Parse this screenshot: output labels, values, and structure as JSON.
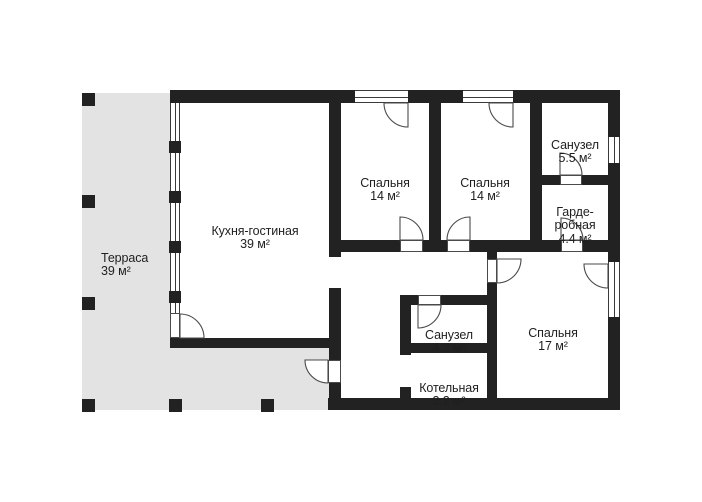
{
  "plan_title": "floor-plan",
  "rooms": [
    {
      "id": "terrace",
      "name": "Терраса",
      "area": "39 м²"
    },
    {
      "id": "kitchen-living",
      "name": "Кухня-гостиная",
      "area": "39 м²"
    },
    {
      "id": "bedroom-1",
      "name": "Спальня",
      "area": "14 м²"
    },
    {
      "id": "bedroom-2",
      "name": "Спальня",
      "area": "14 м²"
    },
    {
      "id": "bathroom-1",
      "name": "Санузел",
      "area": "5.5 м²"
    },
    {
      "id": "wardrobe",
      "name": "Гарде-\nробная",
      "area": "4.4 м²"
    },
    {
      "id": "bathroom-2",
      "name": "Санузел",
      "area": "4.3 м²"
    },
    {
      "id": "boiler-room",
      "name": "Котельная",
      "area": "3.2 м²"
    },
    {
      "id": "bedroom-3",
      "name": "Спальня",
      "area": "17 м²"
    }
  ],
  "colors": {
    "wall": "#222222",
    "terrace_fill": "#e3e3e3",
    "background": "#ffffff",
    "text": "#1f1f1f",
    "door_line": "#4a4a4a"
  }
}
